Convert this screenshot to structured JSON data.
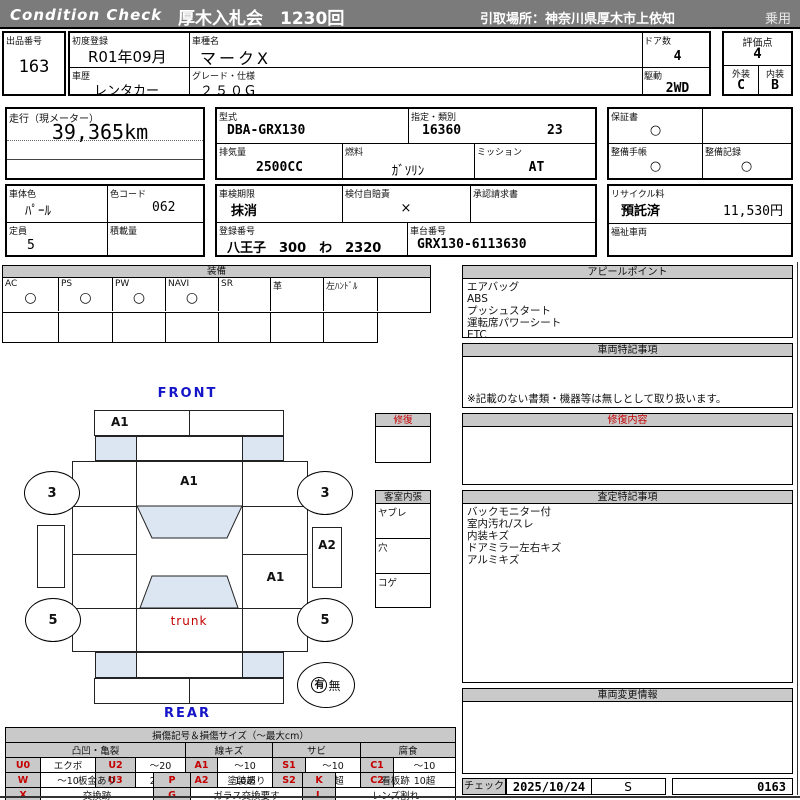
{
  "header": {
    "brand": "Condition Check",
    "title": "厚木入札会　1230回",
    "pickup": "引取場所：神奈川県厚木市上依知",
    "category": "乗用"
  },
  "info": {
    "lot_label": "出品番号",
    "lot": "163",
    "first_reg_label": "初度登録",
    "first_reg": "R01年09月",
    "model_label": "車種名",
    "model": "マークX",
    "history_label": "車歴",
    "history": "レンタカー",
    "grade_label": "グレード・仕様",
    "grade": "２５０G",
    "doors_label": "ドア数",
    "doors": "4",
    "drive_label": "駆動",
    "drive": "2WD",
    "score_label": "評価点",
    "score": "4",
    "exterior_label": "外装",
    "exterior": "C",
    "interior_label": "内装",
    "interior": "B",
    "mileage_label": "走行（現メーター）",
    "mileage": "39,365km",
    "type_label": "型式",
    "type": "DBA-GRX130",
    "class_label": "指定・類別",
    "class1": "16360",
    "class2": "23",
    "disp_label": "排気量",
    "disp": "2500CC",
    "fuel_label": "燃料",
    "fuel": "ｶﾞｿﾘﾝ",
    "mission_label": "ミッション",
    "mission": "AT",
    "warranty_label": "保証書",
    "warranty": "○",
    "book_label": "整備手帳",
    "book": "○",
    "record_label": "整備記録",
    "record": "○",
    "body_color_label": "車体色",
    "body_color": "ﾊﾟｰﾙ",
    "color_code_label": "色コード",
    "color_code": "062",
    "capacity_label": "定員",
    "capacity": "5",
    "load_label": "積載量",
    "load": "",
    "inspection_label": "車検期限",
    "inspection": "抹消",
    "jibaiseki_label": "検付自賠責",
    "jibaiseki": "×",
    "approval_label": "承認請求書",
    "approval": "",
    "recycle_label": "リサイクル料",
    "recycle_status": "預託済",
    "recycle_fee": "11,530円",
    "reg_no_label": "登録番号",
    "reg_no": "八王子　300　わ　2320",
    "chassis_label": "車台番号",
    "chassis": "GRX130-6113630",
    "welfare_label": "福祉車両",
    "welfare": ""
  },
  "equipment": {
    "title": "装備",
    "items": [
      {
        "label": "AC",
        "value": "○"
      },
      {
        "label": "PS",
        "value": "○"
      },
      {
        "label": "PW",
        "value": "○"
      },
      {
        "label": "NAVI",
        "value": "○"
      },
      {
        "label": "SR",
        "value": ""
      },
      {
        "label": "革",
        "value": ""
      },
      {
        "label": "左ﾊﾝﾄﾞﾙ",
        "value": ""
      },
      {
        "label": "",
        "value": ""
      }
    ]
  },
  "panels": {
    "appeal": {
      "title": "アピールポイント",
      "lines": [
        "エアバッグ",
        "ABS",
        "プッシュスタート",
        "運転席パワーシート",
        "ETC"
      ]
    },
    "special": {
      "title": "車両特記事項",
      "note": "※記載のない書類・機器等は無しとして取り扱います。"
    },
    "repair": {
      "title": "修復内容"
    },
    "assessment": {
      "title": "査定特記事項",
      "lines": [
        "バックモニター付",
        "室内汚れ/スレ",
        "内装キズ",
        "ドアミラー左右キズ",
        "アルミキズ"
      ]
    },
    "change": {
      "title": "車両変更情報"
    }
  },
  "check": {
    "label": "チェック",
    "date": "2025/10/24",
    "inspector": "S",
    "number": "0163"
  },
  "diagram": {
    "front_label": "FRONT",
    "rear_label": "REAR",
    "front_bumper_mark": "A1",
    "hood_mark": "A1",
    "corner_fl": "3",
    "corner_fr": "3",
    "corner_rl": "5",
    "corner_rr": "5",
    "rocker_right_mark": "A2",
    "rear_door_right_mark": "A1",
    "trunk_label": "trunk",
    "spare_yes": "有",
    "spare_no": "無",
    "repair_box_title": "修復",
    "interior_box_title": "客室内張",
    "interior_rows": [
      "ヤブレ",
      "穴",
      "コゲ"
    ]
  },
  "legend": {
    "title": "損傷記号＆損傷サイズ（～最大cm）",
    "groups": [
      "凸凹・亀裂",
      "線キズ",
      "サビ",
      "腐食"
    ],
    "rows": [
      [
        "U0",
        "エクボ",
        "U2",
        "～20",
        "A1",
        "～10",
        "S1",
        "～10",
        "C1",
        "～10"
      ],
      [
        "U1",
        "～10",
        "U3",
        "20超",
        "A2",
        "10超",
        "S2",
        "10超",
        "C2",
        "10超"
      ]
    ],
    "rows2": [
      [
        "W",
        "板金あり",
        "P",
        "塗装あり",
        "K",
        "看板跡"
      ],
      [
        "X",
        "交換跡",
        "G",
        "ガラス交換要す",
        "L",
        "レンズ割れ"
      ]
    ]
  },
  "colors": {
    "bar_gray": "#7b7b7b",
    "header_gray": "#c9c9c9",
    "glass_blue": "#dce6f2",
    "accent_red": "#c40000",
    "label_blue": "#1414c8"
  }
}
